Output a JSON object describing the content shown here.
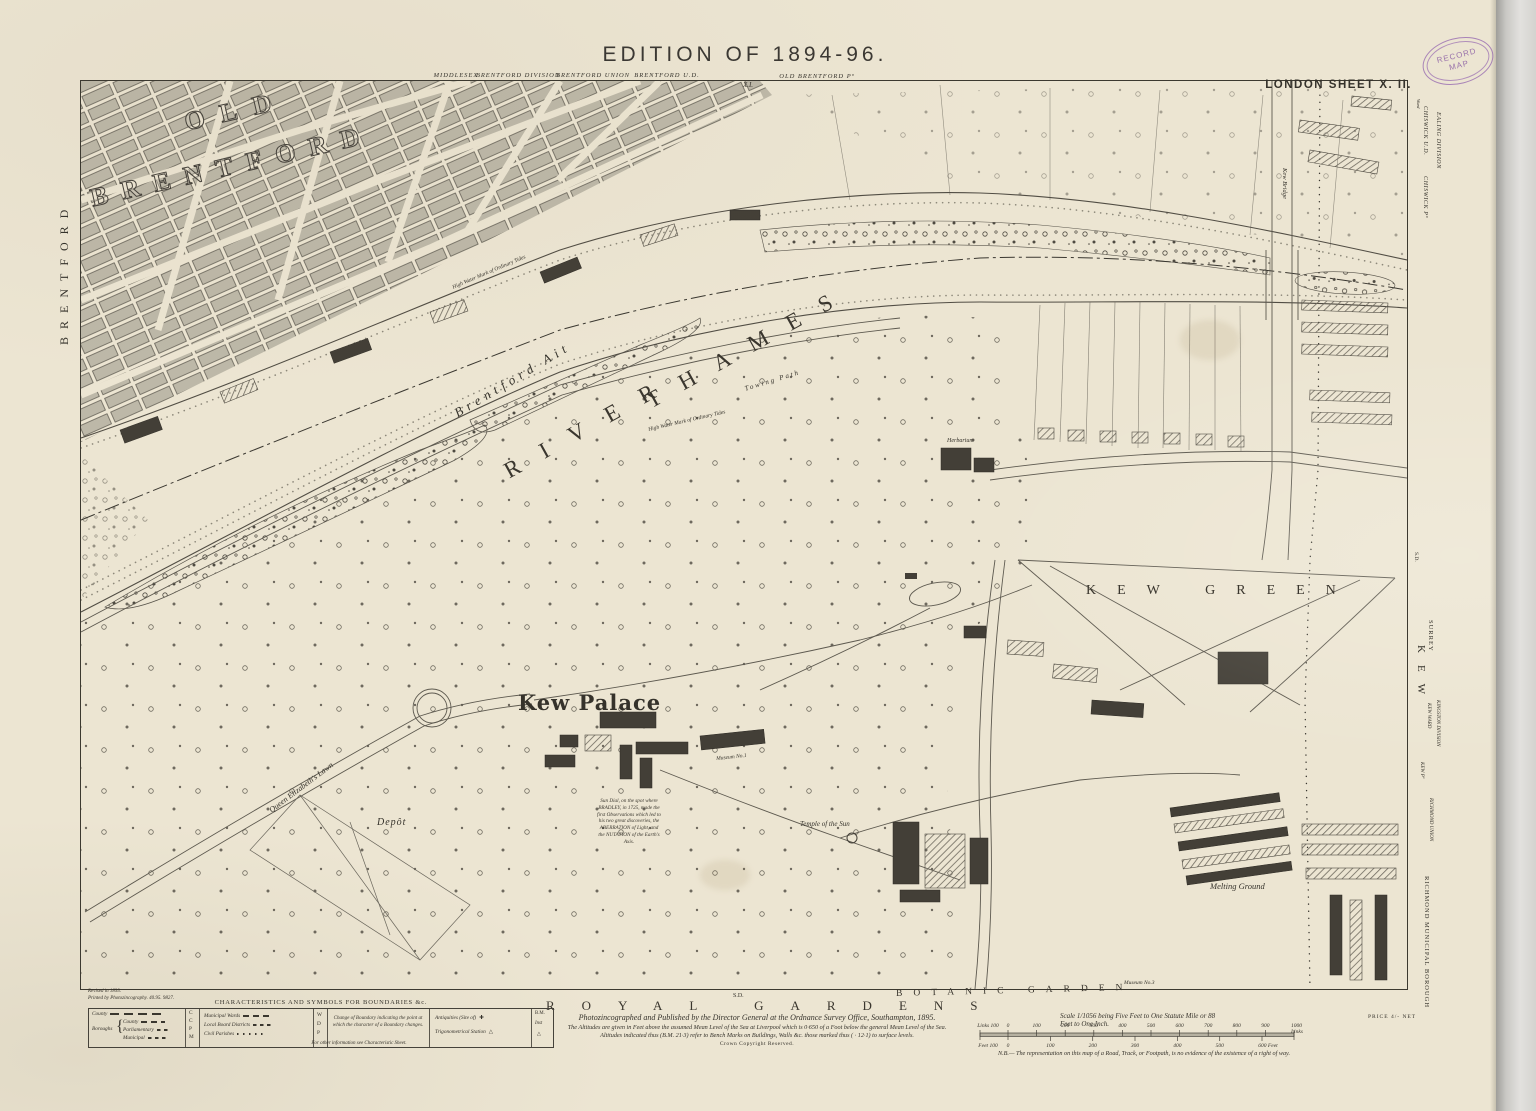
{
  "sheet": {
    "title": "EDITION OF 1894-96.",
    "sheet_label": "LONDON SHEET X. II.",
    "stamp_line1": "RECORD",
    "stamp_line2": "MAP",
    "price": "PRICE 4/- NET"
  },
  "margins": {
    "top": {
      "county": "MIDDLESEX",
      "division": "BRENTFORD DIVISION",
      "union": "BRENTFORD UNION",
      "district": "BRENTFORD U.D.",
      "adjoining_sheet": "X.I.",
      "parish": "OLD BRENTFORD Pº"
    },
    "left": {
      "town": "BRENTFORD"
    },
    "right": {
      "ward": "Ward",
      "district": "CHISWICK U.D.",
      "parish": "CHISWICK Pº",
      "division": "EALING DIVISION",
      "sd": "S.D.",
      "county": "SURREY",
      "kew": "KEW",
      "kingston_division": "KINGSTON DIVISION",
      "kew_ward": "KEW WARD",
      "kew_parish": "KEW Pº",
      "union": "RICHMOND UNION",
      "borough": "RICHMOND MUNICIPAL BOROUGH"
    }
  },
  "map": {
    "old": "OLD",
    "brentford_big": "BRENTFORD",
    "river": "RIVER",
    "thames": "THAMES",
    "brentford_ait": "Brentford Ait",
    "kew_palace": "Kew Palace",
    "kew_green": "KEW GREEN",
    "royal_gardens": "ROYAL GARDENS",
    "botanic_garden": "BOTANIC GARDEN",
    "temple_of_the_sun": "Temple of the Sun",
    "depot": "Depôt",
    "queen_elizabeths_lawn": "Queen Elizabeth's Lawn",
    "towing_path": "Towing Path",
    "high_water_1": "High Water Mark of Ordinary Tides",
    "high_water_2": "High Water Mark of Ordinary Tides",
    "kew_bridge": "Kew Bridge",
    "melting_ground": "Melting Ground",
    "museum_no1": "Museum No.1",
    "museum_no3": "Museum No.3",
    "herbarium": "Herbarium",
    "sd_bottom": "S.D.",
    "sun_dial_note": "Sun Dial, on the spot where BRADLEY, in 1725, made the first Observations which led to his two great discoveries, the ABERRATION of Light, and the NUTATION of the Earth's Axis."
  },
  "legend": {
    "title": "CHARACTERISTICS AND SYMBOLS FOR BOUNDARIES &c.",
    "county_label": "County",
    "boroughs_label": "Boroughs",
    "borough_rows": [
      "County",
      "Parliamentary",
      "Municipal"
    ],
    "letter_col": [
      "C",
      "C",
      "P",
      "M"
    ],
    "ward_rows": [
      "Municipal Wards",
      "Local Board Districts",
      "Civil Parishes"
    ],
    "ward_letters": [
      "W",
      "D",
      "P"
    ],
    "change_note": "Change of Boundary indicating the point at which the character of a Boundary changes.",
    "antiquities": "Antiquities (Site of)",
    "antiquities_symbol": "✚",
    "trig_station": "Trigonometrical Station",
    "trig_symbol": "△",
    "right_col": [
      "B.M.",
      "Inst",
      "△"
    ],
    "footer": "For other information see Characteristic Sheet."
  },
  "imprint": {
    "revised": "Revised in 1893.",
    "printed": "Printed by Photozincography. 40.95. 9827.",
    "line1": "Photozincographed and Published by the Director General at the Ordnance Survey Office, Southampton, 1895.",
    "line2": "The Altitudes are given in Feet above the assumed Mean Level of the Sea at Liverpool which is 0·650 of a Foot below the general Mean Level of the Sea.",
    "line3": "Altitudes indicated thus (B.M. 21·3) refer to Bench Marks on Buildings, Walls &c. those marked thus ( · 12·1) to surface levels.",
    "copyright": "Crown Copyright Reserved."
  },
  "scale": {
    "caption": "Scale 1/1056 being Five Feet to One Statute Mile or 88 Feet to One Inch.",
    "links_labels": [
      "Links 100",
      "0",
      "100",
      "200",
      "300",
      "400",
      "500",
      "600",
      "700",
      "800",
      "900",
      "1000 Links"
    ],
    "feet_labels": [
      "Feet 100",
      "0",
      "100",
      "200",
      "300",
      "400",
      "500",
      "600 Feet"
    ],
    "nb": "N.B.— The representation on this map of a Road, Track, or Footpath, is no evidence of the existence of a right of way."
  },
  "colors": {
    "paper": "#ece5d2",
    "ink": "#35322b",
    "building_dark": "#433f37",
    "building_light": "#b9b4a4",
    "stamp_purple": "#976ab0"
  }
}
